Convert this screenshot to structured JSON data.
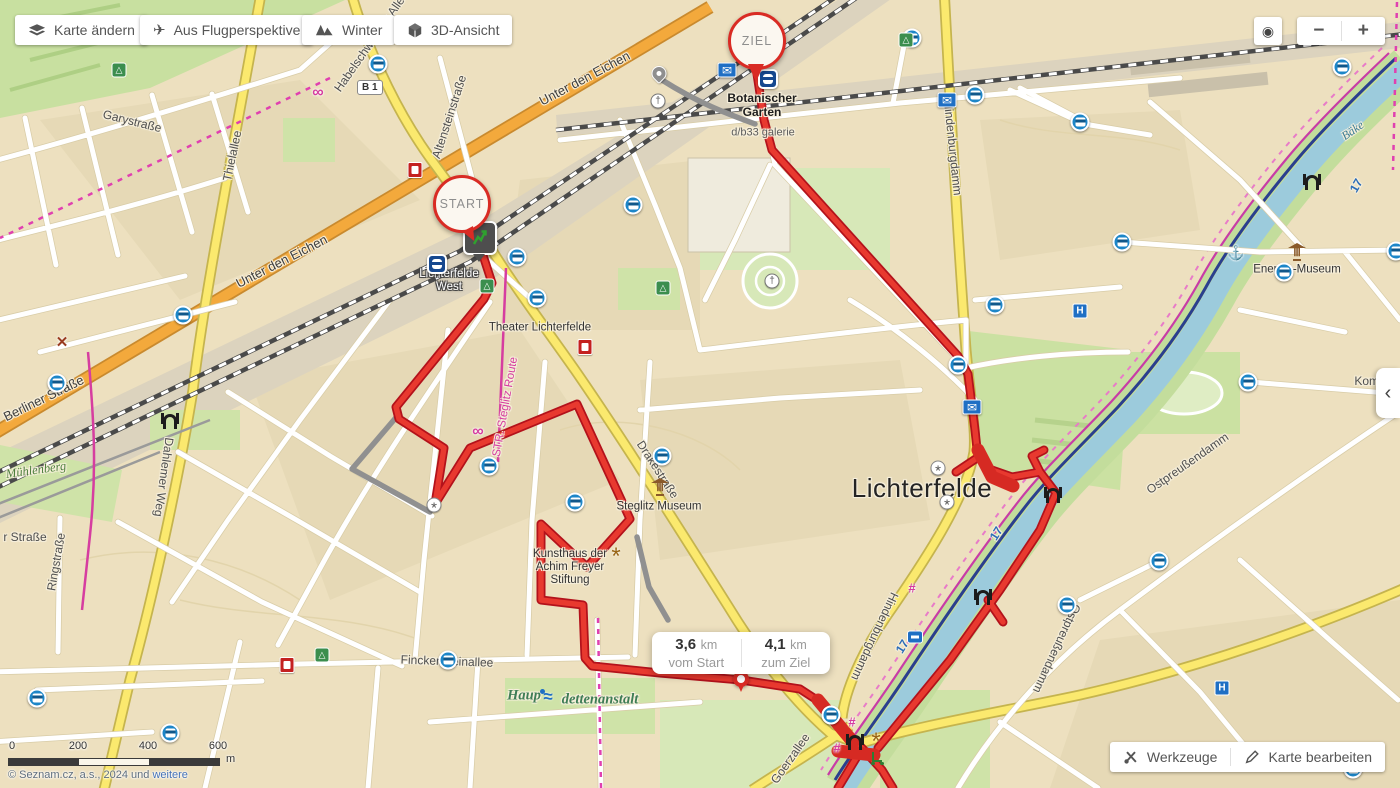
{
  "toolbar": {
    "buttons": [
      {
        "id": "change-map",
        "label": "Karte ändern",
        "icon": "layers-icon"
      },
      {
        "id": "birds-eye",
        "label": "Aus Flugperspektive",
        "icon": "plane-icon"
      },
      {
        "id": "winter",
        "label": "Winter",
        "icon": "mountains-icon"
      },
      {
        "id": "view-3d",
        "label": "3D-Ansicht",
        "icon": "cube-icon"
      }
    ]
  },
  "map_controls": {
    "locate_glyph": "◉",
    "zoom_out": "−",
    "zoom_in": "+",
    "panel_chevron": "‹"
  },
  "markers": {
    "start": "START",
    "finish": "ZIEL"
  },
  "distance_tooltip": {
    "from_value": "3,6",
    "from_unit": "km",
    "from_label": "vom Start",
    "to_value": "4,1",
    "to_unit": "km",
    "to_label": "zum Ziel"
  },
  "bottom_actions": {
    "tools": "Werkzeuge",
    "edit": "Karte bearbeiten"
  },
  "scale_bar": {
    "ticks": [
      "0",
      "200",
      "400",
      "600"
    ],
    "unit": "m"
  },
  "attribution": {
    "text": "© Seznam.cz, a.s., 2024 und ",
    "link_label": "weitere"
  },
  "road_shield": {
    "label": "B 1"
  },
  "colors": {
    "route_red": "#E8392F",
    "route_outline": "#B3121B",
    "route_alt_gray": "#909090",
    "water": "#9CCBDC",
    "road_yellow": "#FBE96E",
    "road_orange": "#F3A93C",
    "accent_blue": "#1D86C8",
    "marker_red": "#D92B24",
    "magenta": "#D63DA0"
  },
  "map_labels": [
    {
      "t": "Garystraße",
      "x": 132,
      "y": 122,
      "r": 14,
      "c": "street"
    },
    {
      "t": "Thielallee",
      "x": 233,
      "y": 156,
      "r": -78,
      "c": "street"
    },
    {
      "t": "Altensteinstraße",
      "x": 450,
      "y": 117,
      "r": -72,
      "c": "street"
    },
    {
      "t": "Habelschwerdter Allee",
      "x": 372,
      "y": 42,
      "r": -55,
      "c": "street"
    },
    {
      "t": "Unter den Eichen",
      "x": 585,
      "y": 79,
      "r": -28,
      "c": "road"
    },
    {
      "t": "Unter den Eichen",
      "x": 282,
      "y": 262,
      "r": -27,
      "c": "road"
    },
    {
      "t": "Berliner Straße",
      "x": 44,
      "y": 399,
      "r": -26,
      "c": "road"
    },
    {
      "t": "Dahlemer Weg",
      "x": 163,
      "y": 477,
      "r": 98,
      "c": "street"
    },
    {
      "t": "Mühlenberg",
      "x": 36,
      "y": 470,
      "r": -8,
      "c": "green"
    },
    {
      "t": "r Straße",
      "x": 25,
      "y": 538,
      "r": 0,
      "c": "street"
    },
    {
      "t": "Ringstraße",
      "x": 57,
      "y": 562,
      "r": -80,
      "c": "street"
    },
    {
      "t": "Finckensteinallee",
      "x": 447,
      "y": 662,
      "r": 2,
      "c": "street"
    },
    {
      "t": "Haup",
      "x": 524,
      "y": 696,
      "r": 0,
      "c": "greenbig"
    },
    {
      "t": "dettenanstalt",
      "x": 600,
      "y": 700,
      "r": 0,
      "c": "greenbig"
    },
    {
      "t": "Lichterfelde\nWest",
      "x": 449,
      "y": 281,
      "r": 0,
      "c": "stationwhite"
    },
    {
      "t": "Theater Lichterfelde",
      "x": 540,
      "y": 328,
      "r": 0,
      "c": "poiname"
    },
    {
      "t": "STR. Steglitz Route",
      "x": 506,
      "y": 407,
      "r": -80,
      "c": "magenta"
    },
    {
      "t": "Steglitz Museum",
      "x": 659,
      "y": 507,
      "r": 0,
      "c": "poiname"
    },
    {
      "t": "Kunsthaus der\nAchim Freyer\nStiftung",
      "x": 570,
      "y": 568,
      "r": 0,
      "c": "poiname"
    },
    {
      "t": "Drakestraße",
      "x": 657,
      "y": 470,
      "r": 57,
      "c": "street"
    },
    {
      "t": "Botanischer\nGarten",
      "x": 762,
      "y": 106,
      "r": 0,
      "c": "station"
    },
    {
      "t": "d/b33 galerie",
      "x": 763,
      "y": 133,
      "r": 0,
      "c": "poismall"
    },
    {
      "t": "Lichterfelde",
      "x": 922,
      "y": 489,
      "r": 0,
      "c": "big"
    },
    {
      "t": "Hindenburgdamm",
      "x": 952,
      "y": 148,
      "r": 84,
      "c": "street"
    },
    {
      "t": "Hindenburgdamm",
      "x": 874,
      "y": 636,
      "r": 115,
      "c": "street"
    },
    {
      "t": "Ostpreußendamm",
      "x": 1188,
      "y": 464,
      "r": -35,
      "c": "street"
    },
    {
      "t": "Ostpreußendamm",
      "x": 1056,
      "y": 648,
      "r": 115,
      "c": "street"
    },
    {
      "t": "Goerzallee",
      "x": 791,
      "y": 759,
      "r": -55,
      "c": "street"
    },
    {
      "t": "Energie-Museum",
      "x": 1297,
      "y": 270,
      "r": 0,
      "c": "poiname"
    },
    {
      "t": "Komponis",
      "x": 1381,
      "y": 382,
      "r": 0,
      "c": "street"
    },
    {
      "t": "Bäke",
      "x": 1353,
      "y": 131,
      "r": -35,
      "c": "water"
    },
    {
      "t": "17",
      "x": 1357,
      "y": 186,
      "r": -60,
      "c": "routenum"
    },
    {
      "t": "17",
      "x": 997,
      "y": 534,
      "r": -58,
      "c": "routenum"
    },
    {
      "t": "17",
      "x": 903,
      "y": 647,
      "r": -58,
      "c": "routenum"
    }
  ],
  "pois": [
    {
      "type": "bus",
      "x": 378,
      "y": 64
    },
    {
      "type": "bus",
      "x": 517,
      "y": 257
    },
    {
      "type": "bus",
      "x": 537,
      "y": 298
    },
    {
      "type": "bus",
      "x": 183,
      "y": 315
    },
    {
      "type": "bus",
      "x": 57,
      "y": 383
    },
    {
      "type": "bus",
      "x": 489,
      "y": 466
    },
    {
      "type": "bus",
      "x": 662,
      "y": 456
    },
    {
      "type": "bus",
      "x": 575,
      "y": 502
    },
    {
      "type": "bus",
      "x": 448,
      "y": 660
    },
    {
      "type": "bus",
      "x": 831,
      "y": 715
    },
    {
      "type": "bus",
      "x": 1067,
      "y": 605
    },
    {
      "type": "bus",
      "x": 912,
      "y": 38
    },
    {
      "type": "bus",
      "x": 958,
      "y": 365
    },
    {
      "type": "bus",
      "x": 1122,
      "y": 242
    },
    {
      "type": "bus",
      "x": 1342,
      "y": 67
    },
    {
      "type": "bus",
      "x": 1248,
      "y": 382
    },
    {
      "type": "bus",
      "x": 1284,
      "y": 272
    },
    {
      "type": "bus",
      "x": 1159,
      "y": 561
    },
    {
      "type": "bus",
      "x": 1353,
      "y": 769
    },
    {
      "type": "bus",
      "x": 633,
      "y": 205
    },
    {
      "type": "bus",
      "x": 975,
      "y": 95
    },
    {
      "type": "bus",
      "x": 1080,
      "y": 122
    },
    {
      "type": "bus",
      "x": 37,
      "y": 698
    },
    {
      "type": "bus",
      "x": 995,
      "y": 305
    },
    {
      "type": "bus",
      "x": 1396,
      "y": 251
    },
    {
      "type": "bus",
      "x": 170,
      "y": 733
    },
    {
      "type": "train",
      "x": 437,
      "y": 264
    },
    {
      "type": "train",
      "x": 768,
      "y": 79
    },
    {
      "type": "post",
      "x": 727,
      "y": 70
    },
    {
      "type": "post",
      "x": 947,
      "y": 100
    },
    {
      "type": "post",
      "x": 972,
      "y": 407
    },
    {
      "type": "museum",
      "x": 660,
      "y": 487
    },
    {
      "type": "museum",
      "x": 1297,
      "y": 252
    },
    {
      "type": "church",
      "x": 658,
      "y": 101
    },
    {
      "type": "church",
      "x": 772,
      "y": 281
    },
    {
      "type": "gas",
      "x": 585,
      "y": 347
    },
    {
      "type": "gas",
      "x": 415,
      "y": 170
    },
    {
      "type": "gas",
      "x": 287,
      "y": 665
    },
    {
      "type": "windmill",
      "x": 62,
      "y": 342
    },
    {
      "type": "bridge",
      "x": 170,
      "y": 419
    },
    {
      "type": "bridge",
      "x": 1053,
      "y": 493
    },
    {
      "type": "bridge",
      "x": 855,
      "y": 740
    },
    {
      "type": "bridge",
      "x": 983,
      "y": 595
    },
    {
      "type": "bridge",
      "x": 1312,
      "y": 180
    },
    {
      "type": "anchor",
      "x": 1236,
      "y": 253
    },
    {
      "type": "swim",
      "x": 548,
      "y": 697
    },
    {
      "type": "scooter",
      "x": 877,
      "y": 758
    },
    {
      "type": "star",
      "x": 616,
      "y": 553
    },
    {
      "type": "star",
      "x": 876,
      "y": 738
    },
    {
      "type": "tram",
      "x": 852,
      "y": 722
    },
    {
      "type": "tram",
      "x": 837,
      "y": 748
    },
    {
      "type": "tram",
      "x": 912,
      "y": 588
    },
    {
      "type": "spoke",
      "x": 434,
      "y": 505
    },
    {
      "type": "spoke",
      "x": 938,
      "y": 468
    },
    {
      "type": "spoke",
      "x": 947,
      "y": 502
    },
    {
      "type": "hospital",
      "x": 1080,
      "y": 311
    },
    {
      "type": "hospital",
      "x": 1222,
      "y": 688
    },
    {
      "type": "ferry",
      "x": 915,
      "y": 637
    },
    {
      "type": "playground",
      "x": 906,
      "y": 40
    },
    {
      "type": "playground",
      "x": 663,
      "y": 288
    },
    {
      "type": "playground",
      "x": 487,
      "y": 286
    },
    {
      "type": "playground",
      "x": 322,
      "y": 655
    },
    {
      "type": "playground",
      "x": 119,
      "y": 70
    },
    {
      "type": "bike",
      "x": 318,
      "y": 93
    },
    {
      "type": "bike",
      "x": 478,
      "y": 432
    },
    {
      "type": "pin-gray",
      "x": 659,
      "y": 75
    }
  ]
}
